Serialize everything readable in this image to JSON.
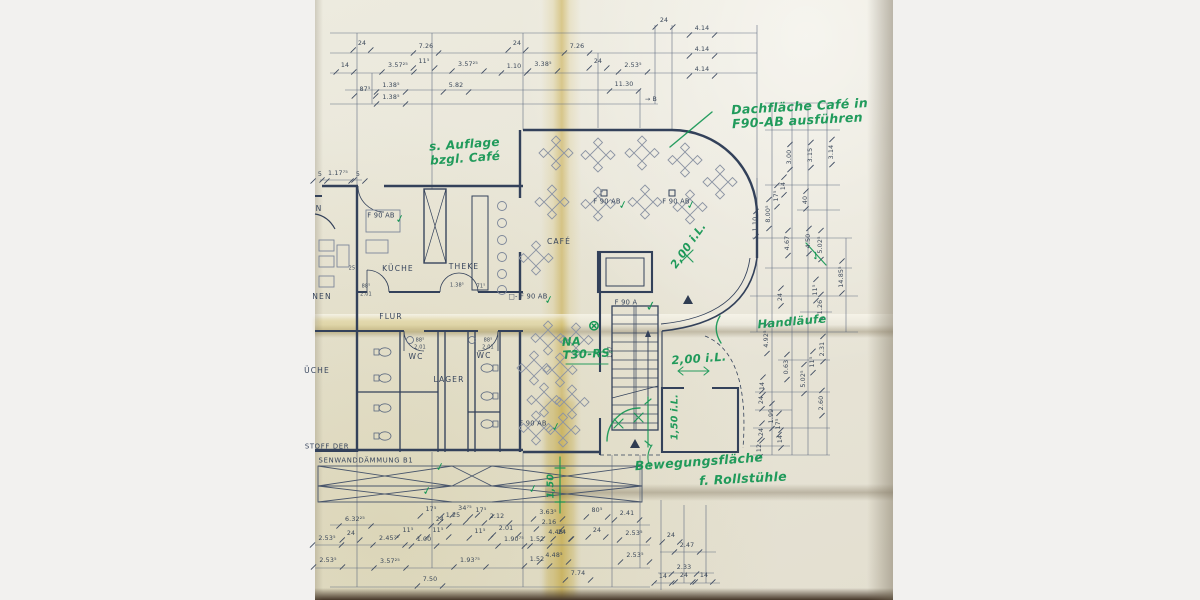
{
  "colors": {
    "paper": "#e9e6d9",
    "margin_bg": "#f2f1ef",
    "plan_ink": "#36445c",
    "green_ink": "#129552",
    "fold_yellow": "#bf9c26"
  },
  "plan_text": {
    "rooms": [
      {
        "t": "KÜCHE",
        "x": 398,
        "y": 269
      },
      {
        "t": "THEKE",
        "x": 464,
        "y": 267
      },
      {
        "t": "CAFÉ",
        "x": 559,
        "y": 242
      },
      {
        "t": "FLUR",
        "x": 391,
        "y": 317
      },
      {
        "t": "WC",
        "x": 416,
        "y": 357
      },
      {
        "t": "WC",
        "x": 484,
        "y": 356
      },
      {
        "t": "LAGER",
        "x": 449,
        "y": 380
      },
      {
        "t": "NEN",
        "x": 322,
        "y": 297
      },
      {
        "t": "N",
        "x": 319,
        "y": 209
      },
      {
        "t": "ÜCHE",
        "x": 317,
        "y": 371
      }
    ],
    "fire_labels": [
      {
        "t": "F 90 AB",
        "x": 381,
        "y": 216
      },
      {
        "t": "F 90 AB",
        "x": 607,
        "y": 202
      },
      {
        "t": "F 90 AB",
        "x": 676,
        "y": 202
      },
      {
        "t": "□- F 90 AB",
        "x": 528,
        "y": 297
      },
      {
        "t": "F 90 A",
        "x": 626,
        "y": 303
      },
      {
        "t": "F 90 AB",
        "x": 533,
        "y": 424
      }
    ],
    "notes": [
      {
        "t": "STOFF DER",
        "x": 327,
        "y": 447
      },
      {
        "t": "SENWANDDÄMMUNG B1",
        "x": 366,
        "y": 461
      }
    ],
    "dims_top": [
      {
        "t": "24",
        "x": 362,
        "y": 44
      },
      {
        "t": "7.26",
        "x": 426,
        "y": 47
      },
      {
        "t": "24",
        "x": 517,
        "y": 44
      },
      {
        "t": "7.26",
        "x": 577,
        "y": 47
      },
      {
        "t": "24",
        "x": 664,
        "y": 21
      },
      {
        "t": "4.14",
        "x": 702,
        "y": 29
      },
      {
        "t": "4.14",
        "x": 702,
        "y": 50
      },
      {
        "t": "4.14",
        "x": 702,
        "y": 70
      },
      {
        "t": "14",
        "x": 345,
        "y": 66
      },
      {
        "t": "3.57²⁵",
        "x": 398,
        "y": 66
      },
      {
        "t": "11⁵",
        "x": 424,
        "y": 62
      },
      {
        "t": "3.57²⁵",
        "x": 468,
        "y": 65
      },
      {
        "t": "1.10",
        "x": 514,
        "y": 67
      },
      {
        "t": "3.38⁵",
        "x": 543,
        "y": 65
      },
      {
        "t": "24",
        "x": 598,
        "y": 62
      },
      {
        "t": "2.53⁵",
        "x": 633,
        "y": 66
      },
      {
        "t": "87⁵",
        "x": 365,
        "y": 90
      },
      {
        "t": "1.38⁵",
        "x": 391,
        "y": 86
      },
      {
        "t": "1.38⁵",
        "x": 391,
        "y": 98
      },
      {
        "t": "5.82",
        "x": 456,
        "y": 86
      },
      {
        "t": "11.30",
        "x": 624,
        "y": 85
      },
      {
        "t": "→ B",
        "x": 651,
        "y": 100
      },
      {
        "t": "5",
        "x": 320,
        "y": 175
      },
      {
        "t": "1.17⁷⁵",
        "x": 338,
        "y": 174
      },
      {
        "t": "5",
        "x": 358,
        "y": 175
      }
    ],
    "dims_bottom": [
      {
        "t": "6.32²⁵",
        "x": 355,
        "y": 520
      },
      {
        "t": "17⁵",
        "x": 431,
        "y": 510
      },
      {
        "t": "24",
        "x": 440,
        "y": 520
      },
      {
        "t": "1.25",
        "x": 453,
        "y": 516
      },
      {
        "t": "34⁷⁵",
        "x": 465,
        "y": 509
      },
      {
        "t": "17⁵",
        "x": 481,
        "y": 511
      },
      {
        "t": "2.12",
        "x": 497,
        "y": 517
      },
      {
        "t": "3.63⁵",
        "x": 548,
        "y": 513
      },
      {
        "t": "80⁵",
        "x": 597,
        "y": 511
      },
      {
        "t": "2.41",
        "x": 627,
        "y": 514
      },
      {
        "t": "2.53⁵",
        "x": 327,
        "y": 539
      },
      {
        "t": "24",
        "x": 351,
        "y": 534
      },
      {
        "t": "2.45⁷⁵",
        "x": 389,
        "y": 539
      },
      {
        "t": "11⁵",
        "x": 408,
        "y": 531
      },
      {
        "t": "1.00",
        "x": 424,
        "y": 540
      },
      {
        "t": "11⁵",
        "x": 438,
        "y": 531
      },
      {
        "t": "11⁵",
        "x": 480,
        "y": 532
      },
      {
        "t": "2.01",
        "x": 506,
        "y": 529
      },
      {
        "t": "1.90⁷⁵",
        "x": 514,
        "y": 540
      },
      {
        "t": "1.52",
        "x": 537,
        "y": 540
      },
      {
        "t": "24",
        "x": 562,
        "y": 533
      },
      {
        "t": "2.16",
        "x": 549,
        "y": 523
      },
      {
        "t": "4.48⁵",
        "x": 557,
        "y": 533
      },
      {
        "t": "24",
        "x": 597,
        "y": 531
      },
      {
        "t": "2.53⁵",
        "x": 634,
        "y": 534
      },
      {
        "t": "2.53⁵",
        "x": 328,
        "y": 561
      },
      {
        "t": "3.57²⁵",
        "x": 390,
        "y": 562
      },
      {
        "t": "1.93⁷⁵",
        "x": 470,
        "y": 561
      },
      {
        "t": "1.52",
        "x": 537,
        "y": 560
      },
      {
        "t": "4.48⁵",
        "x": 554,
        "y": 556
      },
      {
        "t": "2.53⁵",
        "x": 635,
        "y": 556
      },
      {
        "t": "7.50",
        "x": 430,
        "y": 580
      },
      {
        "t": "7.74",
        "x": 578,
        "y": 574
      },
      {
        "t": "24",
        "x": 671,
        "y": 536
      },
      {
        "t": "2.47",
        "x": 687,
        "y": 546
      },
      {
        "t": "2.33",
        "x": 684,
        "y": 568
      },
      {
        "t": "14",
        "x": 663,
        "y": 577
      },
      {
        "t": "24",
        "x": 684,
        "y": 576
      },
      {
        "t": "14",
        "x": 704,
        "y": 576
      }
    ],
    "dims_right": [
      {
        "t": "3.00",
        "x": 790,
        "y": 157
      },
      {
        "t": "3.15",
        "x": 811,
        "y": 155
      },
      {
        "t": "3.14",
        "x": 832,
        "y": 152
      },
      {
        "t": "17⁵",
        "x": 777,
        "y": 196
      },
      {
        "t": "14",
        "x": 784,
        "y": 186
      },
      {
        "t": "40",
        "x": 806,
        "y": 200
      },
      {
        "t": "8.00⁵",
        "x": 769,
        "y": 214
      },
      {
        "t": "1.10",
        "x": 756,
        "y": 224
      },
      {
        "t": "4.67",
        "x": 788,
        "y": 243
      },
      {
        "t": "4.50",
        "x": 809,
        "y": 241
      },
      {
        "t": "5.02⁵",
        "x": 821,
        "y": 245
      },
      {
        "t": "14.85⁵",
        "x": 842,
        "y": 277
      },
      {
        "t": "11⁵",
        "x": 816,
        "y": 290
      },
      {
        "t": "24",
        "x": 781,
        "y": 297
      },
      {
        "t": "1.26",
        "x": 821,
        "y": 307
      },
      {
        "t": "4.92⁵",
        "x": 767,
        "y": 339
      },
      {
        "t": "2.31",
        "x": 823,
        "y": 349
      },
      {
        "t": "0.63",
        "x": 787,
        "y": 367
      },
      {
        "t": "11⁵",
        "x": 813,
        "y": 362
      },
      {
        "t": "5.02⁵",
        "x": 804,
        "y": 379
      },
      {
        "t": "14",
        "x": 763,
        "y": 386
      },
      {
        "t": "24",
        "x": 762,
        "y": 400
      },
      {
        "t": "2.60",
        "x": 822,
        "y": 403
      },
      {
        "t": "1.99",
        "x": 772,
        "y": 416
      },
      {
        "t": "17⁵",
        "x": 779,
        "y": 424
      },
      {
        "t": "24",
        "x": 762,
        "y": 432
      },
      {
        "t": "14",
        "x": 781,
        "y": 439
      },
      {
        "t": "12",
        "x": 760,
        "y": 448
      }
    ],
    "dims_small": [
      {
        "t": "25",
        "x": 352,
        "y": 269
      },
      {
        "t": "88⁵",
        "x": 366,
        "y": 287
      },
      {
        "t": "2.01",
        "x": 366,
        "y": 295
      },
      {
        "t": "1.38⁵",
        "x": 457,
        "y": 286
      },
      {
        "t": "71⁵",
        "x": 481,
        "y": 287
      },
      {
        "t": "88⁵",
        "x": 420,
        "y": 341
      },
      {
        "t": "2.01",
        "x": 420,
        "y": 348
      },
      {
        "t": "88⁵",
        "x": 488,
        "y": 341
      },
      {
        "t": "2.01",
        "x": 488,
        "y": 348
      },
      {
        "t": "1.87",
        "x": 611,
        "y": 352,
        "r": -90
      }
    ]
  },
  "handwriting": {
    "notes": [
      {
        "lines": [
          "Dachfläche Café in",
          "F90-AB ausführen"
        ],
        "x": 800,
        "y": 114,
        "r": -3,
        "s": 12.5
      },
      {
        "lines": [
          "s. Auflage",
          "bzgl. Café"
        ],
        "x": 465,
        "y": 152,
        "r": -4,
        "s": 12
      },
      {
        "lines": [
          "NA",
          "T30-RS"
        ],
        "x": 586,
        "y": 348,
        "r": -3,
        "s": 11.5
      },
      {
        "lines": [
          "2,00 i.L."
        ],
        "x": 689,
        "y": 246,
        "r": -55,
        "s": 11
      },
      {
        "lines": [
          "2,00 i.L."
        ],
        "x": 699,
        "y": 359,
        "r": -4,
        "s": 11.5
      },
      {
        "lines": [
          "Handläufe"
        ],
        "x": 792,
        "y": 322,
        "r": -5,
        "s": 11.5
      },
      {
        "lines": [
          "Bewegungsfläche"
        ],
        "x": 699,
        "y": 462,
        "r": -4,
        "s": 12.5
      },
      {
        "lines": [
          "f. Rollstühle"
        ],
        "x": 743,
        "y": 479,
        "r": -3,
        "s": 12.5
      },
      {
        "lines": [
          "1,50 i.L."
        ],
        "x": 676,
        "y": 417,
        "r": -90,
        "s": 9.5
      },
      {
        "lines": [
          "1,50"
        ],
        "x": 552,
        "y": 486,
        "r": -90,
        "s": 9.5
      }
    ],
    "checks": [
      {
        "x": 400,
        "y": 219
      },
      {
        "x": 623,
        "y": 205
      },
      {
        "x": 691,
        "y": 205
      },
      {
        "x": 549,
        "y": 300
      },
      {
        "x": 651,
        "y": 307,
        "s": 13
      },
      {
        "x": 556,
        "y": 427
      },
      {
        "x": 440,
        "y": 467
      },
      {
        "x": 427,
        "y": 491
      },
      {
        "x": 533,
        "y": 489
      },
      {
        "x": 816,
        "y": 256,
        "r": -40
      }
    ],
    "symbols": [
      {
        "t": "⊗",
        "x": 594,
        "y": 326,
        "s": 15
      }
    ]
  }
}
